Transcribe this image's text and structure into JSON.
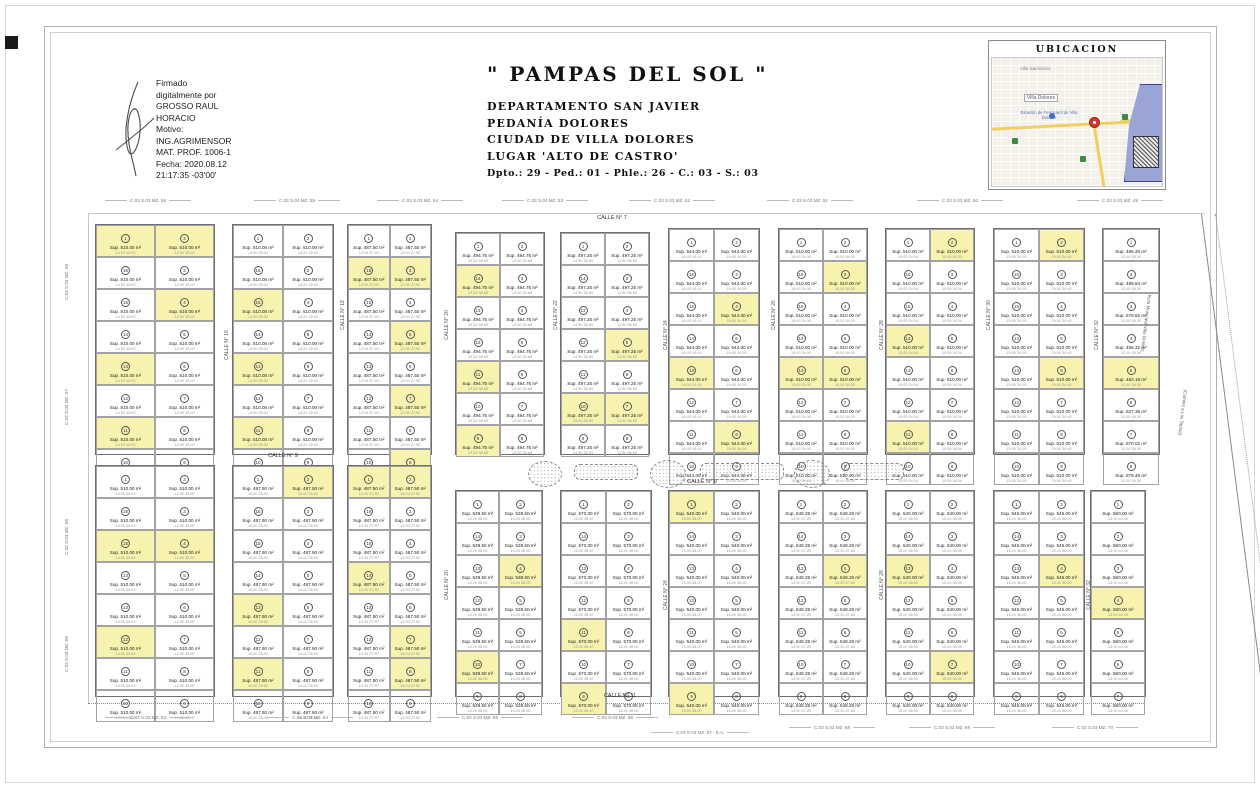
{
  "signature": {
    "lines": [
      "Firmado",
      "digitalmente por",
      "GROSSO RAUL",
      "HORACIO",
      "Motivo:",
      "ING.AGRIMENSOR",
      "MAT. PROF. 1006-1",
      "Fecha: 2020.08.12",
      "21:17:35 -03'00'"
    ]
  },
  "title_block": {
    "title": "\" PAMPAS DEL SOL \"",
    "lines": [
      "DEPARTAMENTO SAN JAVIER",
      "PEDANÍA DOLORES",
      "CIUDAD DE VILLA DOLORES",
      "LUGAR 'ALTO DE CASTRO'"
    ],
    "nomenclature": "Dpto.: 29 - Ped.: 01 - Phle.: 26 - C.: 03 - S.: 03"
  },
  "ubicacion": {
    "title": "UBICACION",
    "town_label": "Villa Sarmiento",
    "city_label": "Villa Dolores",
    "station_label": "Estación de Ferrocarril de Villa Dolores"
  },
  "streets_horizontal": [
    {
      "label": "CALLE N° 7",
      "x": 612,
      "y": 215
    },
    {
      "label": "CALLE N° 9",
      "x": 283,
      "y": 453
    },
    {
      "label": "CALLE N° 9",
      "x": 702,
      "y": 479
    },
    {
      "label": "CALLE N° 11",
      "x": 620,
      "y": 693
    }
  ],
  "streets_vertical": [
    {
      "label": "CALLE N° 16",
      "x": 224,
      "y": 360
    },
    {
      "label": "CALLE N° 18",
      "x": 340,
      "y": 330
    },
    {
      "label": "CALLE N° 20",
      "x": 444,
      "y": 340
    },
    {
      "label": "CALLE N° 22",
      "x": 553,
      "y": 330
    },
    {
      "label": "CALLE N° 24",
      "x": 663,
      "y": 350
    },
    {
      "label": "CALLE N° 26",
      "x": 771,
      "y": 330
    },
    {
      "label": "CALLE N° 28",
      "x": 879,
      "y": 350
    },
    {
      "label": "CALLE N° 30",
      "x": 986,
      "y": 330
    },
    {
      "label": "CALLE N° 32",
      "x": 1094,
      "y": 350
    },
    {
      "label": "CALLE N° 20",
      "x": 444,
      "y": 600
    },
    {
      "label": "CALLE N° 24",
      "x": 663,
      "y": 610
    },
    {
      "label": "CALLE N° 28",
      "x": 879,
      "y": 600
    },
    {
      "label": "CALLE N° 32",
      "x": 1086,
      "y": 610
    }
  ],
  "mz_labels_top": [
    {
      "label": "C.03 S.03 MZ. 56",
      "x": 148,
      "y": 197
    },
    {
      "label": "C.03 S.03 MZ. 55",
      "x": 297,
      "y": 197
    },
    {
      "label": "C.03 S.03 MZ. 54",
      "x": 420,
      "y": 197
    },
    {
      "label": "C.03 S.03 MZ. 53",
      "x": 545,
      "y": 197
    },
    {
      "label": "C.03 S.03 MZ. 52",
      "x": 672,
      "y": 197
    },
    {
      "label": "C.03 S.03 MZ. 51",
      "x": 810,
      "y": 197
    },
    {
      "label": "C.03 S.03 MZ. 50",
      "x": 960,
      "y": 197
    },
    {
      "label": "C.03 S.03 MZ. 49",
      "x": 1120,
      "y": 197
    }
  ],
  "mz_labels_bottom": [
    {
      "label": "C.03 S.03 MZ. 63",
      "x": 148,
      "y": 714
    },
    {
      "label": "C.03 S.03 MZ. 64",
      "x": 310,
      "y": 714
    },
    {
      "label": "C.03 S.03 MZ. 65",
      "x": 480,
      "y": 714
    },
    {
      "label": "C.03 S.03 MZ. 66",
      "x": 615,
      "y": 714
    },
    {
      "label": "C.03 S.03 MZ. 67 - E.V.",
      "x": 700,
      "y": 729
    },
    {
      "label": "C.03 S.03 MZ. 68",
      "x": 832,
      "y": 724
    },
    {
      "label": "C.03 S.03 MZ. 69",
      "x": 952,
      "y": 724
    },
    {
      "label": "C.03 S.03 MZ. 70",
      "x": 1095,
      "y": 724
    }
  ],
  "mz_labels_left": [
    {
      "label": "C.03 S.03 MZ. 58",
      "x": 64,
      "y": 300
    },
    {
      "label": "C.03 S.03 MZ. 57",
      "x": 64,
      "y": 425
    },
    {
      "label": "C.03 S.03 MZ. 66",
      "x": 64,
      "y": 555
    },
    {
      "label": "C.03 S.03 MZ. 65",
      "x": 64,
      "y": 672
    }
  ],
  "boundary_roads": [
    {
      "label": "Ruta Municipal Villa Dolores",
      "x": 1152,
      "y": 295
    },
    {
      "label": "(Camino a Las Tapias)",
      "x": 1188,
      "y": 390
    }
  ],
  "green_shapes": [
    {
      "type": "ellipse",
      "x": 528,
      "y": 461,
      "w": 32,
      "h": 24
    },
    {
      "type": "rrect",
      "x": 574,
      "y": 464,
      "w": 62,
      "h": 14
    },
    {
      "type": "ellipse",
      "x": 650,
      "y": 460,
      "w": 34,
      "h": 26
    },
    {
      "type": "rrect",
      "x": 700,
      "y": 463,
      "w": 82,
      "h": 15
    },
    {
      "type": "ellipse",
      "x": 794,
      "y": 460,
      "w": 34,
      "h": 26
    },
    {
      "type": "rrect",
      "x": 844,
      "y": 463,
      "w": 58,
      "h": 15
    }
  ],
  "blocks": [
    {
      "x": 95,
      "y": 224,
      "w": 120,
      "h": 231,
      "rows": 8,
      "cols": 2,
      "area": "510.00",
      "dims": "14.50  35.00",
      "yellow": [
        [
          0,
          0
        ],
        [
          0,
          1
        ],
        [
          2,
          1
        ],
        [
          4,
          0
        ],
        [
          6,
          0
        ]
      ]
    },
    {
      "x": 232,
      "y": 224,
      "w": 102,
      "h": 231,
      "rows": 8,
      "cols": 2,
      "area": "510.00",
      "dims": "14.50  35.00",
      "yellow": [
        [
          2,
          0
        ],
        [
          4,
          0
        ],
        [
          6,
          0
        ]
      ]
    },
    {
      "x": 347,
      "y": 224,
      "w": 85,
      "h": 231,
      "rows": 8,
      "cols": 2,
      "area": "487.50",
      "dims": "13.00  37.50",
      "yellow": [
        [
          1,
          0
        ],
        [
          1,
          1
        ],
        [
          3,
          1
        ],
        [
          5,
          1
        ],
        [
          7,
          1
        ]
      ]
    },
    {
      "x": 455,
      "y": 232,
      "w": 90,
      "h": 223,
      "rows": 7,
      "cols": 2,
      "area": "494.75",
      "dims": "13.50  36.65",
      "yellow": [
        [
          1,
          0
        ],
        [
          4,
          0
        ],
        [
          6,
          0
        ]
      ]
    },
    {
      "x": 560,
      "y": 232,
      "w": 90,
      "h": 223,
      "rows": 7,
      "cols": 2,
      "area": "497.25",
      "dims": "13.50  36.83",
      "yellow": [
        [
          3,
          1
        ],
        [
          5,
          0
        ],
        [
          5,
          1
        ]
      ]
    },
    {
      "x": 668,
      "y": 228,
      "w": 92,
      "h": 227,
      "rows": 8,
      "cols": 2,
      "area": "544.00",
      "dims": "16.00  34.00",
      "yellow": [
        [
          2,
          1
        ],
        [
          4,
          0
        ],
        [
          6,
          1
        ]
      ]
    },
    {
      "x": 778,
      "y": 228,
      "w": 90,
      "h": 227,
      "rows": 8,
      "cols": 2,
      "area": "510.00",
      "dims": "15.00  34.00",
      "yellow": [
        [
          1,
          1
        ],
        [
          4,
          0
        ],
        [
          4,
          1
        ]
      ]
    },
    {
      "x": 885,
      "y": 228,
      "w": 90,
      "h": 227,
      "rows": 8,
      "cols": 2,
      "area": "510.00",
      "dims": "15.00  34.00",
      "yellow": [
        [
          0,
          1
        ],
        [
          3,
          0
        ],
        [
          6,
          0
        ]
      ]
    },
    {
      "x": 993,
      "y": 228,
      "w": 92,
      "h": 227,
      "rows": 8,
      "cols": 2,
      "area": "510.00",
      "dims": "15.00  34.00",
      "yellow": [
        [
          0,
          1
        ],
        [
          4,
          1
        ]
      ]
    },
    {
      "x": 1102,
      "y": 228,
      "w": 58,
      "h": 227,
      "rows": 8,
      "cols": 1,
      "area": "498.84",
      "areas": [
        "486.20",
        "498.84",
        "576.82",
        "456.32",
        "483.19",
        "527.36",
        "570.02",
        "579.48"
      ],
      "dims": "12.50  38.30",
      "yellow": [
        [
          4,
          0
        ]
      ]
    },
    {
      "x": 95,
      "y": 465,
      "w": 120,
      "h": 232,
      "rows": 8,
      "cols": 2,
      "area": "510.00",
      "dims": "14.50  35.00",
      "yellow": [
        [
          2,
          0
        ],
        [
          2,
          1
        ],
        [
          5,
          0
        ]
      ]
    },
    {
      "x": 232,
      "y": 465,
      "w": 102,
      "h": 232,
      "rows": 8,
      "cols": 2,
      "area": "487.50",
      "dims": "14.00  35.00",
      "yellow": [
        [
          0,
          1
        ],
        [
          4,
          0
        ],
        [
          6,
          0
        ]
      ]
    },
    {
      "x": 347,
      "y": 465,
      "w": 85,
      "h": 232,
      "rows": 8,
      "cols": 2,
      "area": "487.50",
      "dims": "13.00  37.50",
      "yellow": [
        [
          0,
          0
        ],
        [
          0,
          1
        ],
        [
          3,
          0
        ],
        [
          5,
          1
        ],
        [
          6,
          1
        ]
      ]
    },
    {
      "x": 455,
      "y": 490,
      "w": 88,
      "h": 207,
      "rows": 7,
      "cols": 2,
      "area": "539.50",
      "dims": "14.20  38.00",
      "yellow": [
        [
          2,
          1
        ],
        [
          5,
          0
        ]
      ]
    },
    {
      "x": 560,
      "y": 490,
      "w": 92,
      "h": 207,
      "rows": 7,
      "cols": 2,
      "area": "570.00",
      "dims": "15.00  38.00",
      "yellow": [
        [
          4,
          0
        ],
        [
          6,
          0
        ]
      ]
    },
    {
      "x": 668,
      "y": 490,
      "w": 92,
      "h": 207,
      "rows": 7,
      "cols": 2,
      "area": "540.00",
      "dims": "15.00  36.00",
      "yellow": [
        [
          0,
          0
        ],
        [
          6,
          0
        ]
      ]
    },
    {
      "x": 778,
      "y": 490,
      "w": 90,
      "h": 207,
      "rows": 7,
      "cols": 2,
      "area": "548.25",
      "dims": "14.50  37.80",
      "yellow": [
        [
          2,
          1
        ]
      ]
    },
    {
      "x": 885,
      "y": 490,
      "w": 90,
      "h": 207,
      "rows": 7,
      "cols": 2,
      "area": "540.00",
      "dims": "15.00  36.00",
      "yellow": [
        [
          2,
          0
        ],
        [
          5,
          1
        ]
      ]
    },
    {
      "x": 993,
      "y": 490,
      "w": 92,
      "h": 207,
      "rows": 7,
      "cols": 2,
      "area": "546.00",
      "dims": "15.20  36.00",
      "yellow": [
        [
          2,
          1
        ]
      ]
    },
    {
      "x": 1090,
      "y": 490,
      "w": 56,
      "h": 207,
      "rows": 7,
      "cols": 1,
      "area": "560.00",
      "dims": "13.00  40.00",
      "yellow": [
        [
          3,
          0
        ]
      ]
    }
  ],
  "lot_area_prefix": "Sup.",
  "lot_area_suffix": "m²"
}
